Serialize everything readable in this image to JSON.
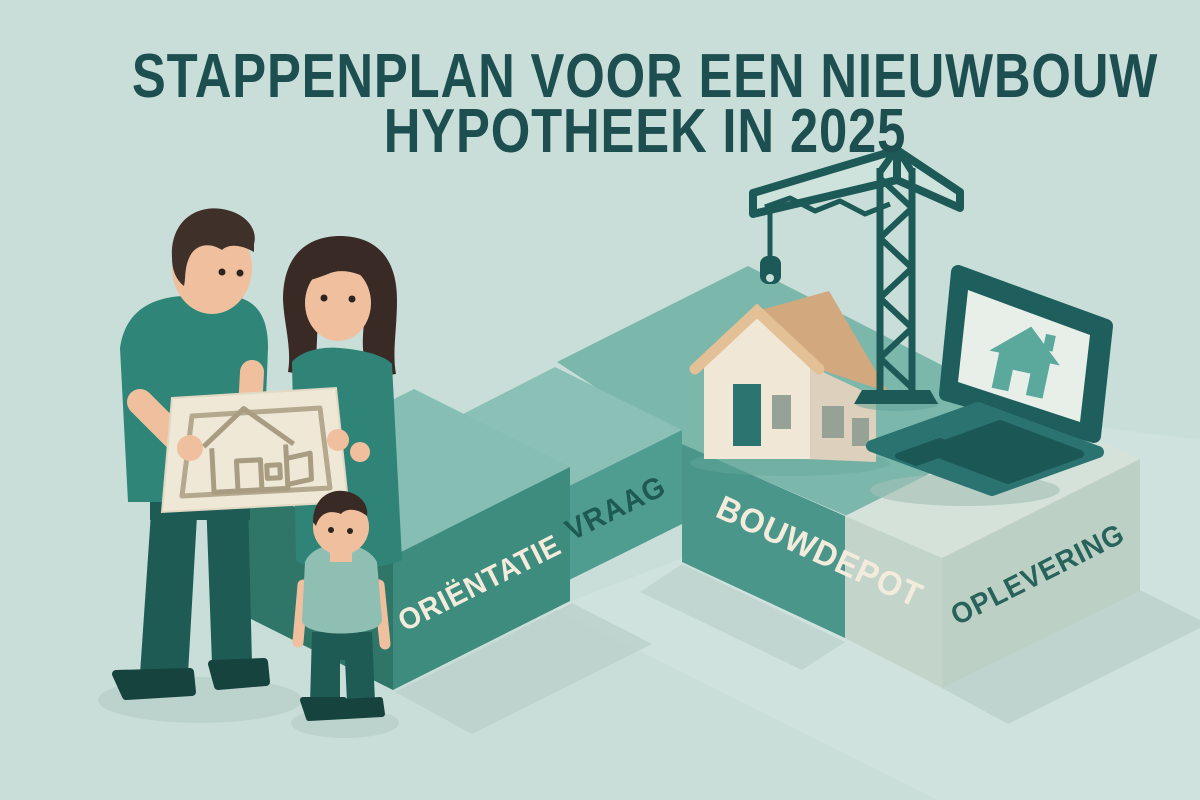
{
  "title": {
    "line1": "STAPPENPLAN VOOR EEN NIEUWBOUW",
    "line2": "HYPOTHEEK IN 2025"
  },
  "steps": [
    {
      "id": "orientatie",
      "label": "ORIËNTATIE",
      "text_color": "#f3ecdc",
      "face_color": "#3e8c7e"
    },
    {
      "id": "vraag",
      "label": "VRAAG",
      "text_color": "#1d5a52",
      "face_color": "#4f9c90"
    },
    {
      "id": "bouwdepot",
      "label": "BOUWDEPOT",
      "text_color": "#f3ecdc",
      "face_color": "#4a968a"
    },
    {
      "id": "oplevering",
      "label": "OPLEVERING",
      "text_color": "#27635a",
      "face_color": "#bdd0c6"
    }
  ],
  "icons": {
    "laptop_screen": "house-icon",
    "construction": "tower-crane-icon",
    "plan": "blueprint-house-icon"
  },
  "colors": {
    "background": "#c9ded9",
    "title": "#1d4f51",
    "step_top": "#86beb3",
    "platform_top": "#7cb7ac",
    "dark_teal": "#1d5a57",
    "pale_block": "#c3d4cb",
    "house_wall": "#f0e7d7",
    "house_roof": "#d2a87e",
    "skin": "#f0c09e",
    "shirt_teal": "#2e8578",
    "child_shirt": "#8fbfb2",
    "shadow": "#b9cfc9"
  }
}
